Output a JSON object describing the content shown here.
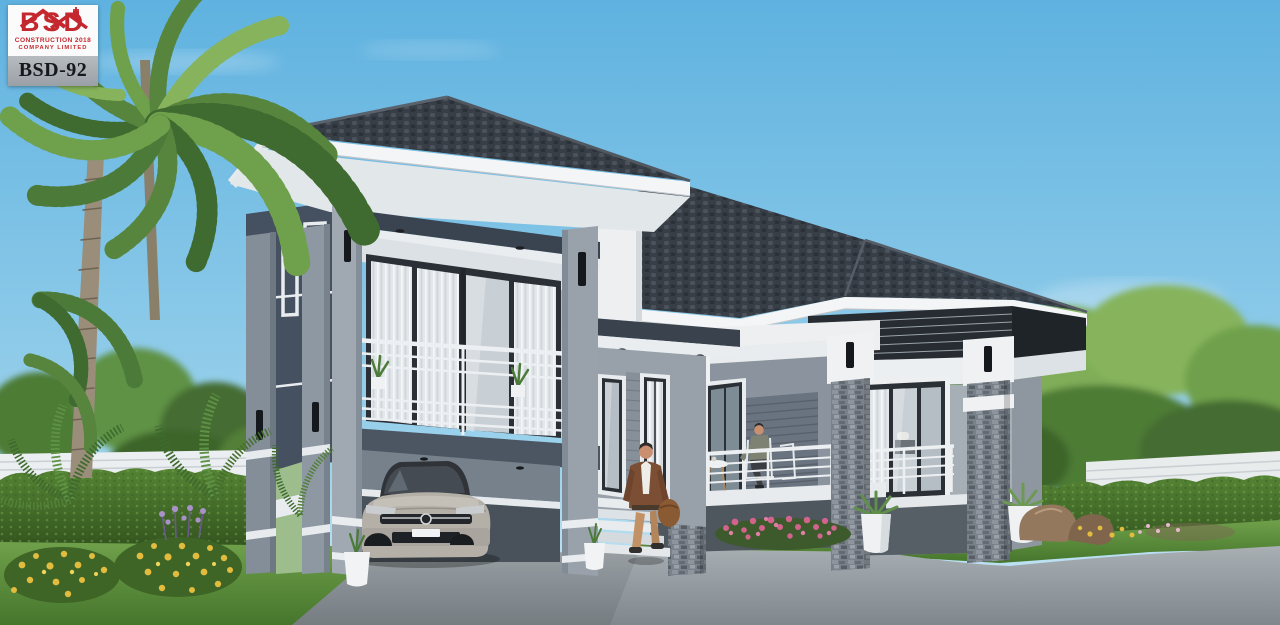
{
  "logo": {
    "brand": "BSD",
    "line1": "CONSTRUCTION 2018",
    "line2": "COMPANY LIMITED",
    "code": "BSD-92"
  },
  "palette": {
    "sky_top": "#5FB2E0",
    "sky_bottom": "#CDE9F5",
    "roof_tile": "#383E46",
    "roof_tile_hi": "#4B525C",
    "fascia": "#F3F5F6",
    "soffit": "#E2E7EA",
    "dark_wall": "#455061",
    "light_wall": "#A6AEB6",
    "column": "#99A1AB",
    "stone": "#79818A",
    "frame": "#2B3036",
    "glass": "#C8CFD5",
    "railing": "#EDF0F2",
    "driveway": "#939BA1",
    "grass": "#5C8C3C",
    "hedge": "#47702F",
    "tree": "#5E9245",
    "palm": "#57853D",
    "flower_yellow": "#E2BC3E",
    "flower_pink": "#D2638D",
    "car_silver": "#B4AFA7",
    "logo_red": "#C4282E",
    "skin": "#C98F6E",
    "jacket": "#7C4F35",
    "pants": "#C29266"
  }
}
